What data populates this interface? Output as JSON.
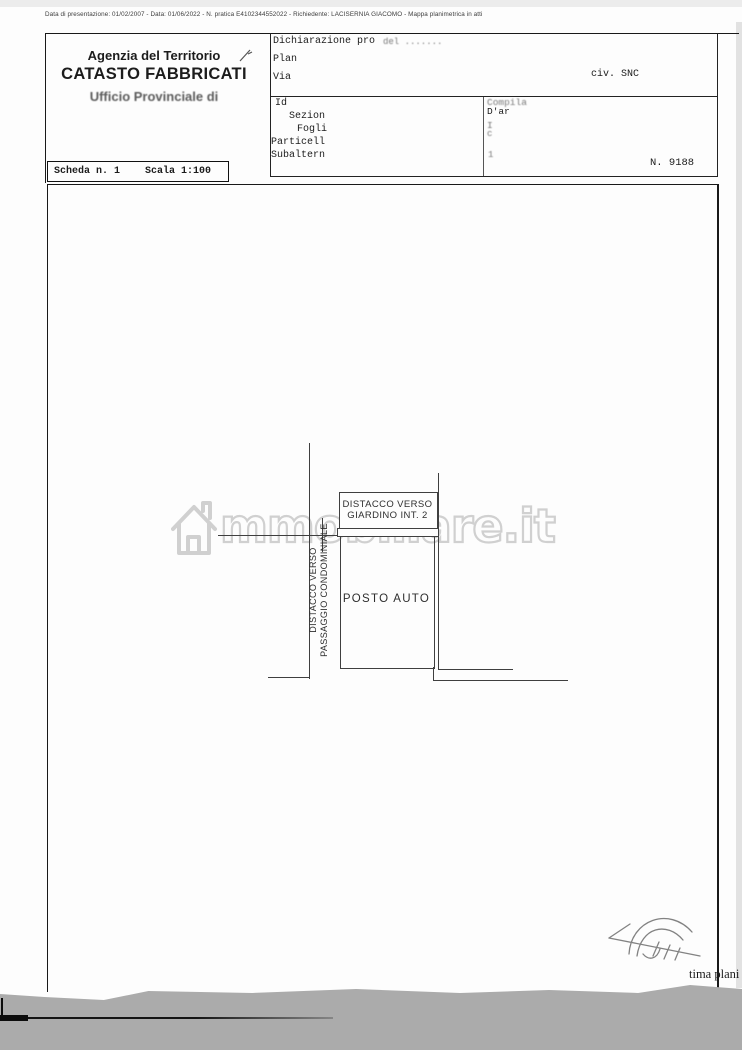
{
  "meta_line": "Data di presentazione: 01/02/2007 - Data: 01/06/2022 - N. pratica E4102344552022 - Richiedente: LACISERNIA GIACOMO - Mappa planimetrica in atti",
  "header": {
    "agency": "Agenzia del Territorio",
    "registry": "CATASTO FABBRICATI",
    "office": "Ufficio Provinciale di",
    "sheet_label": "Scheda n. 1",
    "scale_label": "Scala 1:100"
  },
  "declaration": {
    "line1": "Dichiarazione pro",
    "line1_faded": "del .......",
    "line2": "Plan",
    "line3": "Via",
    "civic": "civ. SNC"
  },
  "identifiers": {
    "title": "Id",
    "rows": [
      "Sezion",
      "Fogli",
      "Particell",
      "Subaltern"
    ],
    "right_col": [
      "Compila",
      "D'ar",
      "I",
      "c",
      "1"
    ],
    "number": "N. 9188"
  },
  "plan": {
    "label_top_line1": "DISTACCO VERSO",
    "label_top_line2": "GIARDINO INT. 2",
    "label_center": "POSTO AUTO",
    "label_left_line1": "DISTACCO VERSO",
    "label_left_line2": "PASSAGGIO CONDOMINIALE"
  },
  "watermark": "mmobiliare.it",
  "footer_note": "tima plani",
  "colors": {
    "plan_line": "#3f3f3f",
    "watermark": "#cdcdcd",
    "paper": "#fdfdfd",
    "scan_background": "#ababab"
  }
}
